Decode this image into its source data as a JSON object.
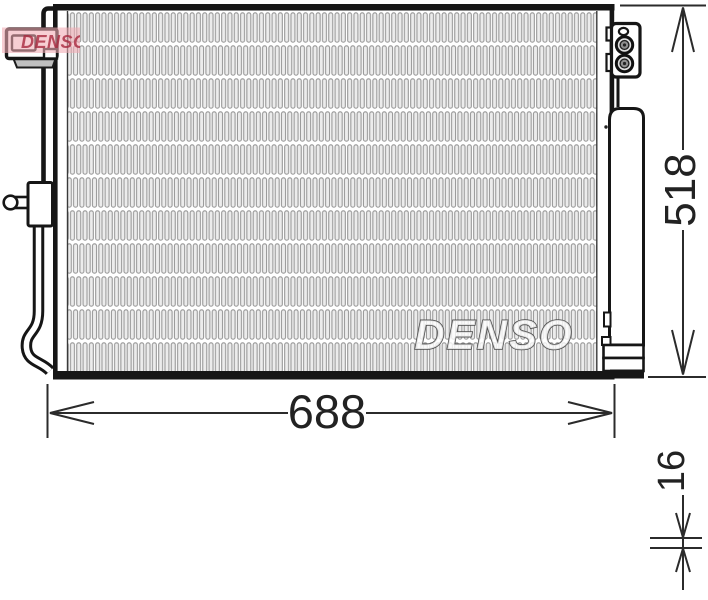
{
  "branding": {
    "center_watermark": "DENSO",
    "corner_watermark": "DENSO"
  },
  "dimensions": {
    "width_mm": "688",
    "height_mm": "518",
    "thickness_mm": "16"
  },
  "colors": {
    "line": "#161616",
    "dimension_line": "#2b2b2b",
    "dimension_text": "#222222",
    "fin_stroke": "#989898",
    "fin_fill": "#ececec",
    "center_watermark_outline": "#4e4e4e",
    "center_watermark_fill": "rgba(255,255,255,0.78)",
    "corner_watermark_band": "#f2aab4",
    "corner_watermark_text": "#a8293e",
    "connector_flange": "#bfbfbf",
    "background": "#ffffff"
  }
}
